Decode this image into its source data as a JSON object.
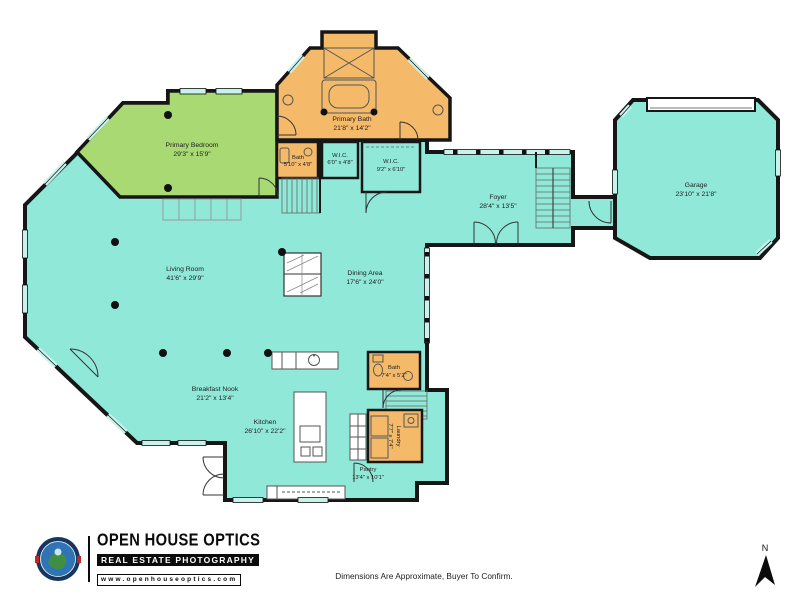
{
  "colors": {
    "room_teal": "#8FE8D8",
    "room_green": "#A9D973",
    "room_orange": "#F4BA6A",
    "wall": "#161616",
    "window_glass": "#C9F2EB"
  },
  "rooms": {
    "primary_bedroom": {
      "name": "Primary Bedroom",
      "dims": "29'3\" x 15'9\""
    },
    "primary_bath": {
      "name": "Primary Bath",
      "dims": "21'8\" x 14'2\""
    },
    "bath_upper": {
      "name": "Bath",
      "dims": "5'10\" x 4'8\""
    },
    "wic_small": {
      "name": "W.I.C.",
      "dims": "6'0\" x 4'8\""
    },
    "wic_large": {
      "name": "W.I.C.",
      "dims": "9'2\" x 6'10\""
    },
    "foyer": {
      "name": "Foyer",
      "dims": "28'4\" x 13'5\""
    },
    "garage": {
      "name": "Garage",
      "dims": "23'10\" x 21'8\""
    },
    "living_room": {
      "name": "Living Room",
      "dims": "41'6\" x 29'9\""
    },
    "dining_area": {
      "name": "Dining Area",
      "dims": "17'6\" x 24'0\""
    },
    "breakfast_nook": {
      "name": "Breakfast Nook",
      "dims": "21'2\" x 13'4\""
    },
    "kitchen": {
      "name": "Kitchen",
      "dims": "26'10\" x 22'2\""
    },
    "bath_lower": {
      "name": "Bath",
      "dims": "7'4\" x 5'2\""
    },
    "laundry": {
      "name": "Laundry",
      "dims": "7'7\" x 7'4\""
    },
    "pantry": {
      "name": "Pantry",
      "dims": "13'4\" x 10'1\""
    }
  },
  "footer": {
    "logo_title": "OPEN HOUSE OPTICS",
    "logo_subtitle": "REAL ESTATE PHOTOGRAPHY",
    "logo_url": "www.openhouseoptics.com",
    "disclaimer": "Dimensions Are Approximate, Buyer To Confirm.",
    "compass_label": "N"
  }
}
